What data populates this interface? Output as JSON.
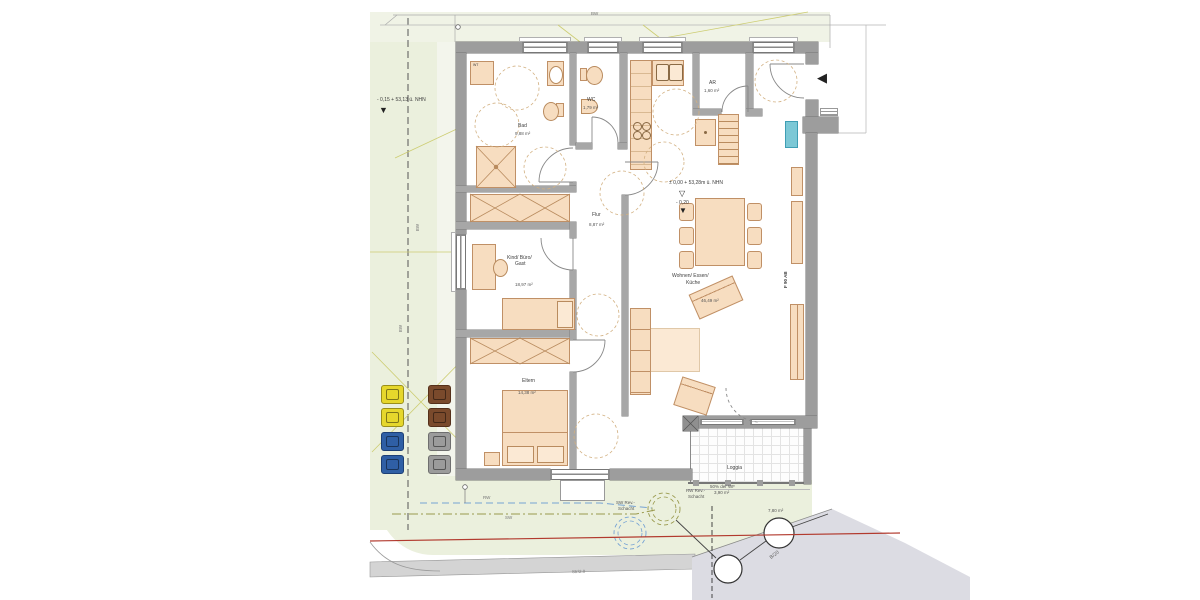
{
  "title": "Grundriss Erdgeschoss",
  "site": {
    "boundary_top": "BW",
    "boundary_left_upper": "BW",
    "boundary_left_lower": "BW",
    "rw_line": "RW",
    "sw_line": "SW",
    "street": "Str/2.0",
    "road": "B/20",
    "rw_shaft_lines": [
      "RW Rev.-",
      "Schacht"
    ],
    "sw_shaft_lines": [
      "SW Rev.-",
      "Schacht"
    ],
    "outside_level": "- 0,15 + 53,13 ü. NHN"
  },
  "building": {
    "inside_level_line": "± 0,00 + 53,28m ü. NHN",
    "inside_level_value": "- 0,20",
    "fire_rating": "F 90 AB",
    "rooms": [
      {
        "name": "Bad",
        "area": "9,88 m²"
      },
      {
        "name": "WC",
        "area": "1,79 m²"
      },
      {
        "name": "AR",
        "area": "1,60 m²"
      },
      {
        "name": "Flur",
        "area": "8,87 m²"
      },
      {
        "name_lines": [
          "Kind/ Büro/",
          "Gast"
        ],
        "area": "18,97 m²"
      },
      {
        "name": "Eltern",
        "area": "14,38 m²"
      },
      {
        "name_lines": [
          "Wohnen/ Essen/",
          "Küche"
        ],
        "area": "46,49 m²"
      },
      {
        "name": "Loggia",
        "note_lines": [
          "50% der WF",
          "3,90 m²"
        ],
        "dim": "7,80 m²"
      }
    ],
    "appliances": {
      "washer": "WT"
    }
  },
  "icons": {
    "level_open_triangle": "▽",
    "level_filled_triangle": "▼",
    "entrance_arrow": "◀"
  },
  "colors": {
    "wall": "#9d9d9d",
    "furniture": "#f7ddc0",
    "site_green": "#ebf0dd",
    "boundary_olive": "#cdcd72",
    "rw_blue": "#76a3d4",
    "red_line": "#b23a2e",
    "teal_unit": "#7cc8d6",
    "bin_yellow": "#e6d72c",
    "bin_blue": "#2f5fa5",
    "bin_brown": "#7a4a2c",
    "bin_gray": "#9b9b9b"
  }
}
